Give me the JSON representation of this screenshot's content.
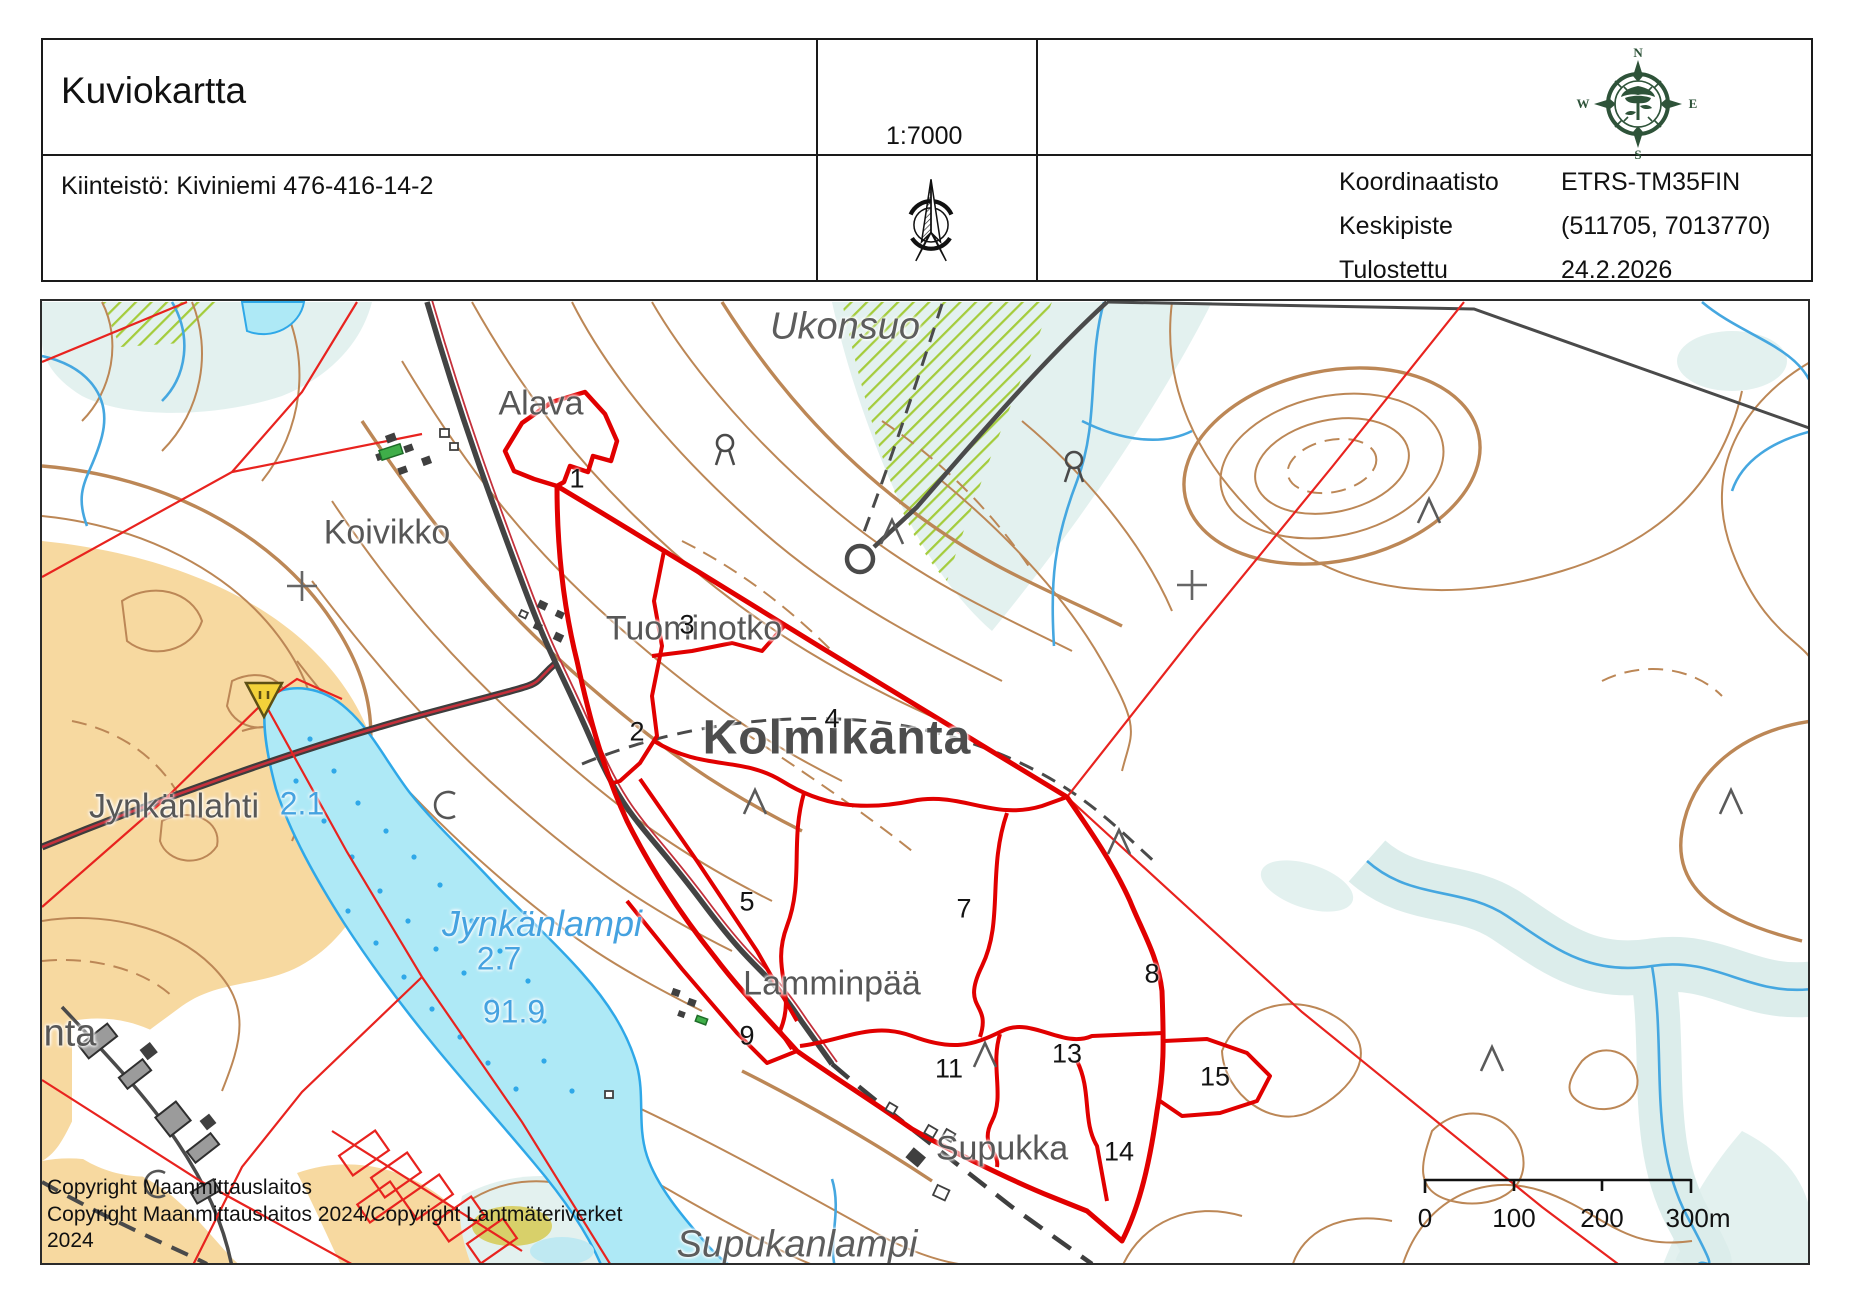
{
  "header": {
    "title": "Kuviokartta",
    "property_label": "Kiinteistö: Kiviniemi 476-416-14-2",
    "scale": "1:7000",
    "info": [
      {
        "label": "Koordinaatisto",
        "value": "ETRS-TM35FIN"
      },
      {
        "label": "Keskipiste",
        "value": "(511705, 7013770)"
      },
      {
        "label": "Tulostettu",
        "value": "24.2.2026"
      }
    ],
    "compass": {
      "n": "N",
      "s": "S",
      "e": "E",
      "w": "W"
    }
  },
  "map": {
    "place_labels": [
      {
        "text": "Ukonsuo",
        "x": 803,
        "y": 26,
        "cls": "name-it"
      },
      {
        "text": "Alava",
        "x": 499,
        "y": 103,
        "cls": "name"
      },
      {
        "text": "Koivikko",
        "x": 345,
        "y": 232,
        "cls": "name"
      },
      {
        "text": "Tuominotko",
        "x": 652,
        "y": 328,
        "cls": "name"
      },
      {
        "text": "Kolmikanta",
        "x": 795,
        "y": 437,
        "cls": "name-lg"
      },
      {
        "text": "Jynkänlahti",
        "x": 132,
        "y": 506,
        "cls": "name"
      },
      {
        "text": "2.1",
        "x": 260,
        "y": 503,
        "cls": "water-num"
      },
      {
        "text": "Jynkänlampi",
        "x": 500,
        "y": 623,
        "cls": "water-it"
      },
      {
        "text": "2.7",
        "x": 457,
        "y": 658,
        "cls": "water-num"
      },
      {
        "text": "91.9",
        "x": 472,
        "y": 711,
        "cls": "water-num"
      },
      {
        "text": "Lamminpää",
        "x": 790,
        "y": 683,
        "cls": "name"
      },
      {
        "text": "nta",
        "x": 28,
        "y": 733,
        "cls": "name-lg2"
      },
      {
        "text": "Supukka",
        "x": 960,
        "y": 848,
        "cls": "name"
      },
      {
        "text": "Supukanlampi",
        "x": 755,
        "y": 944,
        "cls": "name-it"
      }
    ],
    "compartments": [
      {
        "n": "1",
        "x": 535,
        "y": 178
      },
      {
        "n": "2",
        "x": 595,
        "y": 431
      },
      {
        "n": "3",
        "x": 645,
        "y": 324
      },
      {
        "n": "4",
        "x": 790,
        "y": 418
      },
      {
        "n": "5",
        "x": 705,
        "y": 601
      },
      {
        "n": "7",
        "x": 922,
        "y": 608
      },
      {
        "n": "8",
        "x": 1110,
        "y": 673
      },
      {
        "n": "9",
        "x": 705,
        "y": 735
      },
      {
        "n": "11",
        "x": 907,
        "y": 768
      },
      {
        "n": "13",
        "x": 1025,
        "y": 753
      },
      {
        "n": "14",
        "x": 1077,
        "y": 851
      },
      {
        "n": "15",
        "x": 1173,
        "y": 776
      }
    ],
    "scale_bar": {
      "labels": [
        {
          "text": "0",
          "x": 1383
        },
        {
          "text": "100",
          "x": 1472
        },
        {
          "text": "200",
          "x": 1560
        },
        {
          "text": "300m",
          "x": 1656
        }
      ],
      "label_y": 902
    },
    "copyright_lines": [
      "Copyright Maanmittauslaitos",
      "Copyright Maanmittauslaitos 2024/Copyright Lantmäteriverket",
      "2024"
    ],
    "colors": {
      "stand_boundary_red": "#e10000",
      "property_line_red": "#e8231f",
      "contour_brown": "#bc8756",
      "water_fill": "#aee9f6",
      "water_line": "#2fa8e8",
      "field_tan": "#f7d9a0",
      "marsh_pale": "#e3f1ef",
      "swamp_hatch_green": "#a4cc3c",
      "road_gray": "#434343",
      "road_red": "#c4303b",
      "label_gray": "#575757",
      "label_blue": "#45a2e0",
      "sign_yellow": "#f3d23a",
      "building_green": "#3fae49",
      "compass_green": "#2e5339"
    }
  }
}
